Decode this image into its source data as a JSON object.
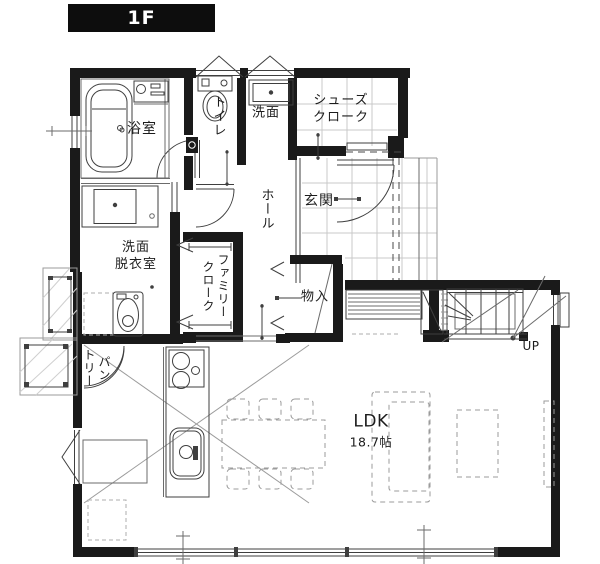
{
  "floor_label": "1F",
  "rooms": {
    "bathroom": "浴室",
    "toilet": "トイレ",
    "washbasin": "洗面",
    "shoe_closet": "シューズ\nクローク",
    "entrance": "玄関",
    "hall": "ホール",
    "washroom": "洗面\n脱衣室",
    "family_closet": "ファミリー\nクローク",
    "storage": "物入",
    "pantry": "パン\nトリー",
    "ldk_name": "LDK",
    "ldk_size": "18.7帖",
    "stairs_up": "UP"
  },
  "colors": {
    "wall": "#1a1a1a",
    "line": "#3f3f3f",
    "tile_line": "#c9c9c9",
    "dashed_furniture": "#9b9b9b",
    "banner_bg": "#0d0d0d",
    "banner_text": "#ffffff",
    "background": "#ffffff"
  },
  "fixtures": [
    "bathtub",
    "shower-panel",
    "toilet",
    "wash-basin",
    "vanity-sink",
    "washing-machine",
    "entrance-door",
    "pantry-double-door",
    "kitchen-island",
    "gas-stove",
    "kitchen-sink",
    "dining-table",
    "dining-chairs",
    "sofa",
    "coffee-table",
    "tv-board",
    "staircase-up",
    "storage-closet",
    "hanger-pipe",
    "water-heater-tank",
    "heat-pump-unit"
  ]
}
